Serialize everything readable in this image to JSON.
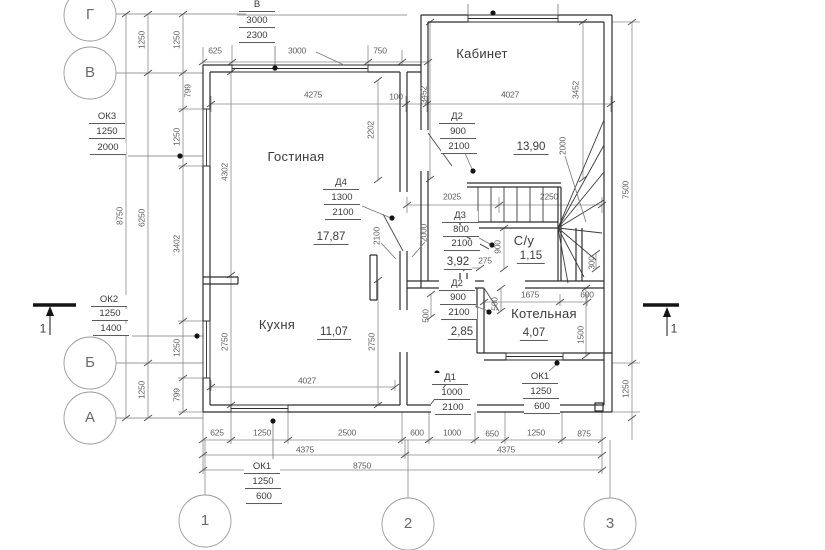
{
  "drawing": {
    "type": "floor-plan",
    "colors": {
      "wall_line": "#2e2e2e",
      "dim_line": "#8a8a8a",
      "grid_line": "#9a9a9a",
      "text": "#3a3a3a",
      "background": "#ffffff"
    }
  },
  "labels": {
    "grid": [
      {
        "n": "axis-label-g",
        "t": "Г",
        "x": 90,
        "y": 15
      },
      {
        "n": "axis-label-v",
        "t": "В",
        "x": 90,
        "y": 73
      },
      {
        "n": "axis-label-b",
        "t": "Б",
        "x": 90,
        "y": 363
      },
      {
        "n": "axis-label-a",
        "t": "А",
        "x": 90,
        "y": 418
      },
      {
        "n": "axis-label-1",
        "t": "1",
        "x": 205,
        "y": 521
      },
      {
        "n": "axis-label-2",
        "t": "2",
        "x": 408,
        "y": 524
      },
      {
        "n": "axis-label-3",
        "t": "3",
        "x": 610,
        "y": 524
      }
    ],
    "sections": [
      {
        "n": "section-mark-1-left",
        "t": "1",
        "x": 43,
        "y": 329
      },
      {
        "n": "section-mark-1-right",
        "t": "1",
        "x": 674,
        "y": 329
      }
    ],
    "rooms": [
      {
        "n": "room-label-gostinaya",
        "t": "Гостиная",
        "x": 296,
        "y": 157
      },
      {
        "n": "room-label-kuhnya",
        "t": "Кухня",
        "x": 277,
        "y": 325
      },
      {
        "n": "room-label-kabinet",
        "t": "Кабинет",
        "x": 482,
        "y": 54
      },
      {
        "n": "room-label-kotelnaya",
        "t": "Котельная",
        "x": 544,
        "y": 314
      },
      {
        "n": "room-label-su",
        "t": "С/у",
        "x": 524,
        "y": 241
      }
    ],
    "areas": [
      {
        "n": "area-gostinaya",
        "t": "17,87",
        "x": 331,
        "y": 238
      },
      {
        "n": "area-kuhnya",
        "t": "11,07",
        "x": 334,
        "y": 333
      },
      {
        "n": "area-kabinet",
        "t": "13,90",
        "x": 531,
        "y": 148
      },
      {
        "n": "area-hall",
        "t": "3,92",
        "x": 458,
        "y": 263
      },
      {
        "n": "area-su",
        "t": "1,15",
        "x": 531,
        "y": 257
      },
      {
        "n": "area-corridor",
        "t": "2,85",
        "x": 462,
        "y": 333
      },
      {
        "n": "area-kotelnaya",
        "t": "4,07",
        "x": 534,
        "y": 334
      }
    ],
    "tags": [
      {
        "n": "tag-window-v",
        "t": "В",
        "x": 257,
        "y": 6
      },
      {
        "n": "tag-window-v-width",
        "t": "3000",
        "x": 257,
        "y": 22
      },
      {
        "n": "tag-window-v-height",
        "t": "2300",
        "x": 257,
        "y": 37
      },
      {
        "n": "tag-ok3",
        "t": "ОК3",
        "x": 107,
        "y": 118
      },
      {
        "n": "tag-ok3-width",
        "t": "1250",
        "x": 107,
        "y": 133
      },
      {
        "n": "tag-ok3-height",
        "t": "2000",
        "x": 108,
        "y": 149
      },
      {
        "n": "tag-ok2",
        "t": "ОК2",
        "x": 109,
        "y": 301
      },
      {
        "n": "tag-ok2-width",
        "t": "1250",
        "x": 110,
        "y": 315
      },
      {
        "n": "tag-ok2-height",
        "t": "1400",
        "x": 111,
        "y": 330
      },
      {
        "n": "tag-ok1-bottom",
        "t": "ОК1",
        "x": 262,
        "y": 468
      },
      {
        "n": "tag-ok1-bottom-width",
        "t": "1250",
        "x": 263,
        "y": 483
      },
      {
        "n": "tag-ok1-bottom-height",
        "t": "600",
        "x": 264,
        "y": 498
      },
      {
        "n": "tag-ok1-right",
        "t": "ОК1",
        "x": 540,
        "y": 378
      },
      {
        "n": "tag-ok1-right-width",
        "t": "1250",
        "x": 541,
        "y": 393
      },
      {
        "n": "tag-ok1-right-height",
        "t": "600",
        "x": 542,
        "y": 408
      },
      {
        "n": "tag-d4",
        "t": "Д4",
        "x": 341,
        "y": 184
      },
      {
        "n": "tag-d4-width",
        "t": "1300",
        "x": 342,
        "y": 199
      },
      {
        "n": "tag-d4-height",
        "t": "2100",
        "x": 343,
        "y": 214
      },
      {
        "n": "tag-d2-top",
        "t": "Д2",
        "x": 457,
        "y": 118
      },
      {
        "n": "tag-d2-top-width",
        "t": "900",
        "x": 458,
        "y": 133
      },
      {
        "n": "tag-d2-top-height",
        "t": "2100",
        "x": 459,
        "y": 148
      },
      {
        "n": "tag-d3",
        "t": "Д3",
        "x": 460,
        "y": 217
      },
      {
        "n": "tag-d3-width",
        "t": "800",
        "x": 461,
        "y": 231
      },
      {
        "n": "tag-d3-height",
        "t": "2100",
        "x": 462,
        "y": 245
      },
      {
        "n": "tag-d2-low",
        "t": "Д2",
        "x": 457,
        "y": 285
      },
      {
        "n": "tag-d2-low-width",
        "t": "900",
        "x": 458,
        "y": 299
      },
      {
        "n": "tag-d2-low-height",
        "t": "2100",
        "x": 459,
        "y": 314
      },
      {
        "n": "tag-d1",
        "t": "Д1",
        "x": 450,
        "y": 379
      },
      {
        "n": "tag-d1-width",
        "t": "1000",
        "x": 452,
        "y": 394
      },
      {
        "n": "tag-d1-height",
        "t": "2100",
        "x": 453,
        "y": 409
      }
    ],
    "dims_h": [
      {
        "n": "dim-625",
        "t": "625",
        "x": 215,
        "y": 51
      },
      {
        "n": "dim-3000",
        "t": "3000",
        "x": 297,
        "y": 51
      },
      {
        "n": "dim-750",
        "t": "750",
        "x": 380,
        "y": 51
      },
      {
        "n": "dim-4275",
        "t": "4275",
        "x": 313,
        "y": 95
      },
      {
        "n": "dim-100",
        "t": "100",
        "x": 396,
        "y": 97
      },
      {
        "n": "dim-4027",
        "t": "4027",
        "x": 510,
        "y": 95
      },
      {
        "n": "dim-2025",
        "t": "2025",
        "x": 452,
        "y": 197
      },
      {
        "n": "dim-2250",
        "t": "2250",
        "x": 549,
        "y": 197
      },
      {
        "n": "dim-275",
        "t": "275",
        "x": 485,
        "y": 261
      },
      {
        "n": "dim-1675",
        "t": "1675",
        "x": 530,
        "y": 295
      },
      {
        "n": "dim-600-kot",
        "t": "600",
        "x": 587,
        "y": 295
      },
      {
        "n": "dim-4027-kitchen",
        "t": "4027",
        "x": 307,
        "y": 381
      },
      {
        "n": "dim-625-bottom",
        "t": "625",
        "x": 217,
        "y": 433
      },
      {
        "n": "dim-1250-bottom",
        "t": "1250",
        "x": 262,
        "y": 433
      },
      {
        "n": "dim-2500-bottom",
        "t": "2500",
        "x": 347,
        "y": 433
      },
      {
        "n": "dim-600-bottom",
        "t": "600",
        "x": 417,
        "y": 433
      },
      {
        "n": "dim-1000-bottom",
        "t": "1000",
        "x": 452,
        "y": 433
      },
      {
        "n": "dim-650-bottom",
        "t": "650",
        "x": 492,
        "y": 434
      },
      {
        "n": "dim-1250b-bottom",
        "t": "1250",
        "x": 536,
        "y": 433
      },
      {
        "n": "dim-875-bottom",
        "t": "875",
        "x": 584,
        "y": 434
      },
      {
        "n": "dim-4375-left",
        "t": "4375",
        "x": 305,
        "y": 450
      },
      {
        "n": "dim-4375-right",
        "t": "4375",
        "x": 506,
        "y": 450
      },
      {
        "n": "dim-8750-bottom",
        "t": "8750",
        "x": 362,
        "y": 466
      }
    ],
    "dims_v": [
      {
        "n": "dim-1250-gv-1",
        "t": "1250",
        "x": 142,
        "y": 40,
        "rot": true
      },
      {
        "n": "dim-1250-gv-2",
        "t": "1250",
        "x": 177,
        "y": 40,
        "rot": true
      },
      {
        "n": "dim-799-top",
        "t": "799",
        "x": 188,
        "y": 91,
        "rot": true
      },
      {
        "n": "dim-1250-ok3",
        "t": "1250",
        "x": 177,
        "y": 137,
        "rot": true
      },
      {
        "n": "dim-4302",
        "t": "4302",
        "x": 225,
        "y": 172,
        "rot": true
      },
      {
        "n": "dim-8750-left",
        "t": "8750",
        "x": 120,
        "y": 216,
        "rot": true
      },
      {
        "n": "dim-6250",
        "t": "6250",
        "x": 142,
        "y": 218,
        "rot": true
      },
      {
        "n": "dim-3402",
        "t": "3402",
        "x": 177,
        "y": 244,
        "rot": true
      },
      {
        "n": "dim-1250-ok2",
        "t": "1250",
        "x": 177,
        "y": 348,
        "rot": true
      },
      {
        "n": "dim-799-bottom",
        "t": "799",
        "x": 177,
        "y": 395,
        "rot": true
      },
      {
        "n": "dim-1250-ba",
        "t": "1250",
        "x": 142,
        "y": 390,
        "rot": true
      },
      {
        "n": "dim-2750-left",
        "t": "2750",
        "x": 225,
        "y": 342,
        "rot": true
      },
      {
        "n": "dim-2750-right",
        "t": "2750",
        "x": 372,
        "y": 342,
        "rot": true
      },
      {
        "n": "dim-2202",
        "t": "2202",
        "x": 371,
        "y": 130,
        "rot": true
      },
      {
        "n": "dim-3452-left",
        "t": "3452",
        "x": 424,
        "y": 95,
        "rot": true
      },
      {
        "n": "dim-3452-right",
        "t": "3452",
        "x": 576,
        "y": 90,
        "rot": true
      },
      {
        "n": "dim-2000-stairs",
        "t": "2000",
        "x": 563,
        "y": 146,
        "rot": true
      },
      {
        "n": "dim-7500",
        "t": "7500",
        "x": 626,
        "y": 190,
        "rot": true
      },
      {
        "n": "dim-2100-mid",
        "t": "2100",
        "x": 377,
        "y": 236,
        "rot": true
      },
      {
        "n": "dim-2000-mid",
        "t": "2000",
        "x": 424,
        "y": 233,
        "rot": true
      },
      {
        "n": "dim-900-su",
        "t": "900",
        "x": 498,
        "y": 247,
        "rot": true
      },
      {
        "n": "dim-500-su",
        "t": "500",
        "x": 495,
        "y": 304,
        "rot": true
      },
      {
        "n": "dim-500-kitchen",
        "t": "500",
        "x": 426,
        "y": 316,
        "rot": true
      },
      {
        "n": "dim-300",
        "t": "300",
        "x": 592,
        "y": 263,
        "rot": true
      },
      {
        "n": "dim-1500",
        "t": "1500",
        "x": 581,
        "y": 335,
        "rot": true
      },
      {
        "n": "dim-1250-right",
        "t": "1250",
        "x": 626,
        "y": 389,
        "rot": true
      }
    ]
  }
}
